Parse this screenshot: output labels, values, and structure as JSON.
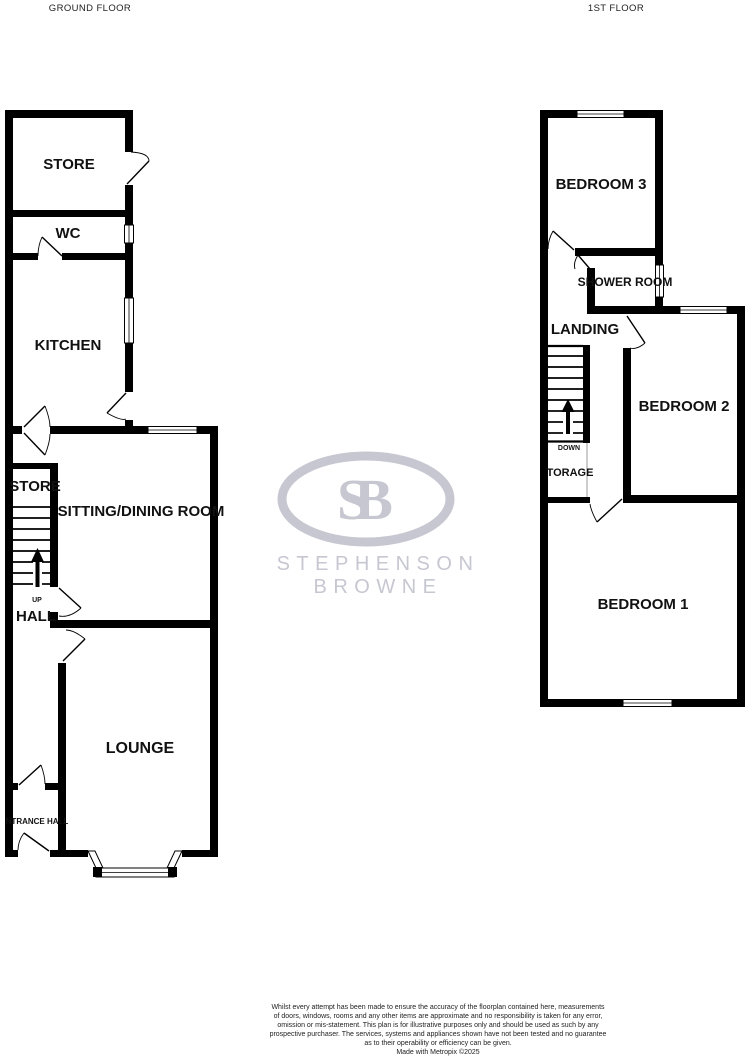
{
  "titles": {
    "ground_floor": "GROUND FLOOR",
    "first_floor": "1ST FLOOR"
  },
  "ground_floor": {
    "rooms": {
      "store_top": "STORE",
      "wc": "WC",
      "kitchen": "KITCHEN",
      "store_mid": "STORE",
      "sitting_dining": "SITTING/DINING ROOM",
      "hall": "HALL",
      "up": "UP",
      "lounge": "LOUNGE",
      "entrance_hall": "NTRANCE HALL"
    }
  },
  "first_floor": {
    "rooms": {
      "bedroom3": "BEDROOM 3",
      "shower_room": "SHOWER ROOM",
      "landing": "LANDING",
      "down": "DOWN",
      "storage": "TORAGE",
      "bedroom2": "BEDROOM 2",
      "bedroom1": "BEDROOM 1"
    }
  },
  "logo": {
    "monogram": "SB",
    "name": "STEPHENSON BROWNE"
  },
  "disclaimer": {
    "lines": [
      "Whilst every attempt has been made to ensure the accuracy of the floorplan contained here, measurements",
      "of doors, windows, rooms and any other items are approximate and no responsibility is taken for any error,",
      "omission or mis-statement. This plan is for illustrative purposes only and should be used as such by any",
      "prospective purchaser. The services, systems and appliances shown have not been tested and no guarantee",
      "as to their operability or efficiency can be given.",
      "Made with Metropix ©2025"
    ]
  },
  "colors": {
    "wall": "#000000",
    "logo_gray": "#c7c7d1",
    "label_text": "#111111"
  }
}
